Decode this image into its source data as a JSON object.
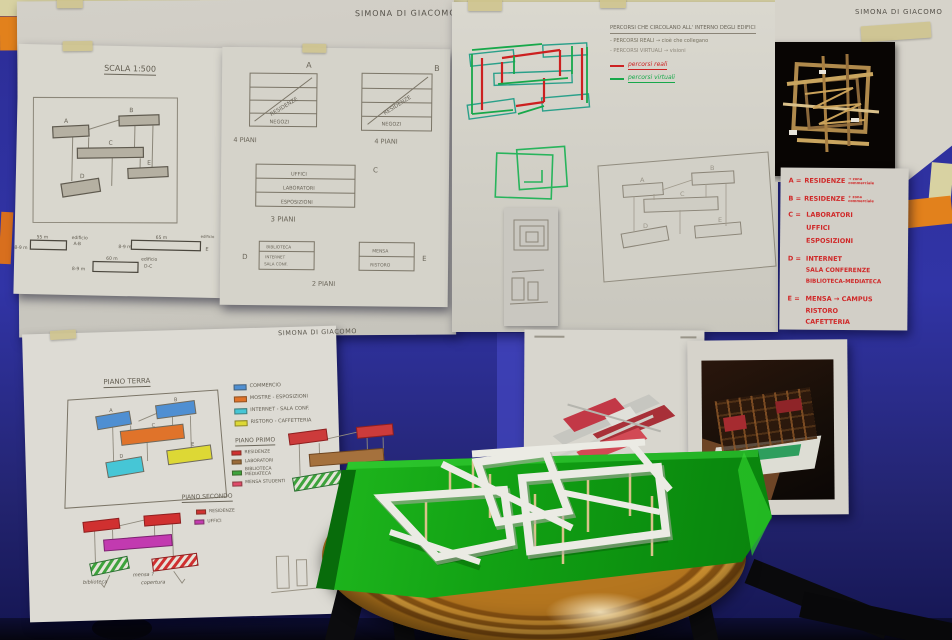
{
  "author": "SIMONA DI GIACOMO",
  "site_plan": {
    "title": "SCALA 1:500",
    "letters": [
      "A",
      "B",
      "C",
      "D",
      "E"
    ],
    "dims": [
      {
        "len": "55 m",
        "h": "8-9 m",
        "name": "edificio",
        "ref": "A-B"
      },
      {
        "len": "65 m",
        "h": "8-9 m",
        "name": "edificio",
        "ref": "E"
      },
      {
        "len": "60 m",
        "h": "8-9 m",
        "name": "edificio",
        "ref": "D-C"
      }
    ]
  },
  "sections": {
    "letters": [
      "A",
      "B",
      "C",
      "D",
      "E"
    ],
    "residenze": "RESIDENZE",
    "negozi": "NEGOZI",
    "piani4": "4 PIANI",
    "piani3": "3 PIANI",
    "piani2": "2 PIANI",
    "c_rows": [
      "UFFICI",
      "LABORATORI",
      "ESPOSIZIONI"
    ],
    "d_rows": [
      "BIBLIOTECA",
      "INTERNET",
      "SALA CONF."
    ],
    "e_rows": [
      "MENSA",
      "RISTORO"
    ]
  },
  "percorsi": {
    "title": "PERCORSI CHE CIRCOLANO ALL' INTERNO DEGLI EDIFICI",
    "reali_note": "- PERCORSI REALI → cioè che collegano",
    "virtuali_note": "- PERCORSI VIRTUALI → visioni",
    "legend_reali": "percorsi reali",
    "legend_virtuali": "percorsi virtuali",
    "color_reali": "#cc2222",
    "color_virtuali": "#17a84a"
  },
  "functions": {
    "a_key": "A =",
    "a_val": "RESIDENZE",
    "a_note": "→ zona commerciale",
    "b_key": "B =",
    "b_val": "RESIDENZE",
    "b_note": "+ zona commerciale",
    "c_key": "C =",
    "c_lines": [
      "LABORATORI",
      "UFFICI",
      "ESPOSIZIONI"
    ],
    "d_key": "D =",
    "d_lines": [
      "INTERNET",
      "SALA CONFERENZE",
      "BIBLIOTECA-MEDIATECA"
    ],
    "e_key": "E =",
    "e_lines": [
      "MENSA → CAMPUS",
      "RISTORO",
      "CAFETTERIA"
    ]
  },
  "floors": {
    "letters": [
      "A",
      "B",
      "C",
      "D",
      "E"
    ],
    "terra_title": "PIANO TERRA",
    "terra_legend": [
      {
        "color": "#4f8fd2",
        "label": "COMMERCIO"
      },
      {
        "color": "#e0732a",
        "label": "MOSTRE - ESPOSIZIONI"
      },
      {
        "color": "#46c6d6",
        "label": "INTERNET - SALA CONF."
      },
      {
        "color": "#ddd835",
        "label": "RISTORO - CAFFETTERIA"
      }
    ],
    "primo_title": "PIANO PRIMO",
    "primo_legend": [
      {
        "color": "#d03030",
        "label": "RESIDENZE"
      },
      {
        "color": "#9a6a38",
        "label": "LABORATORI"
      },
      {
        "color": "#3da33c",
        "label": "BIBLIOTECA MEDIATECA"
      },
      {
        "color": "#e04a6a",
        "label": "MENSA STUDENTI"
      }
    ],
    "secondo_title": "PIANO SECONDO",
    "secondo_legend": [
      {
        "color": "#d03030",
        "label": "RESIDENZE"
      },
      {
        "color": "#c23ab0",
        "label": "UFFICI"
      }
    ],
    "note_biblioteca": "biblioteca",
    "note_mensa": "mensa ?",
    "note_copertura": "copertura"
  }
}
